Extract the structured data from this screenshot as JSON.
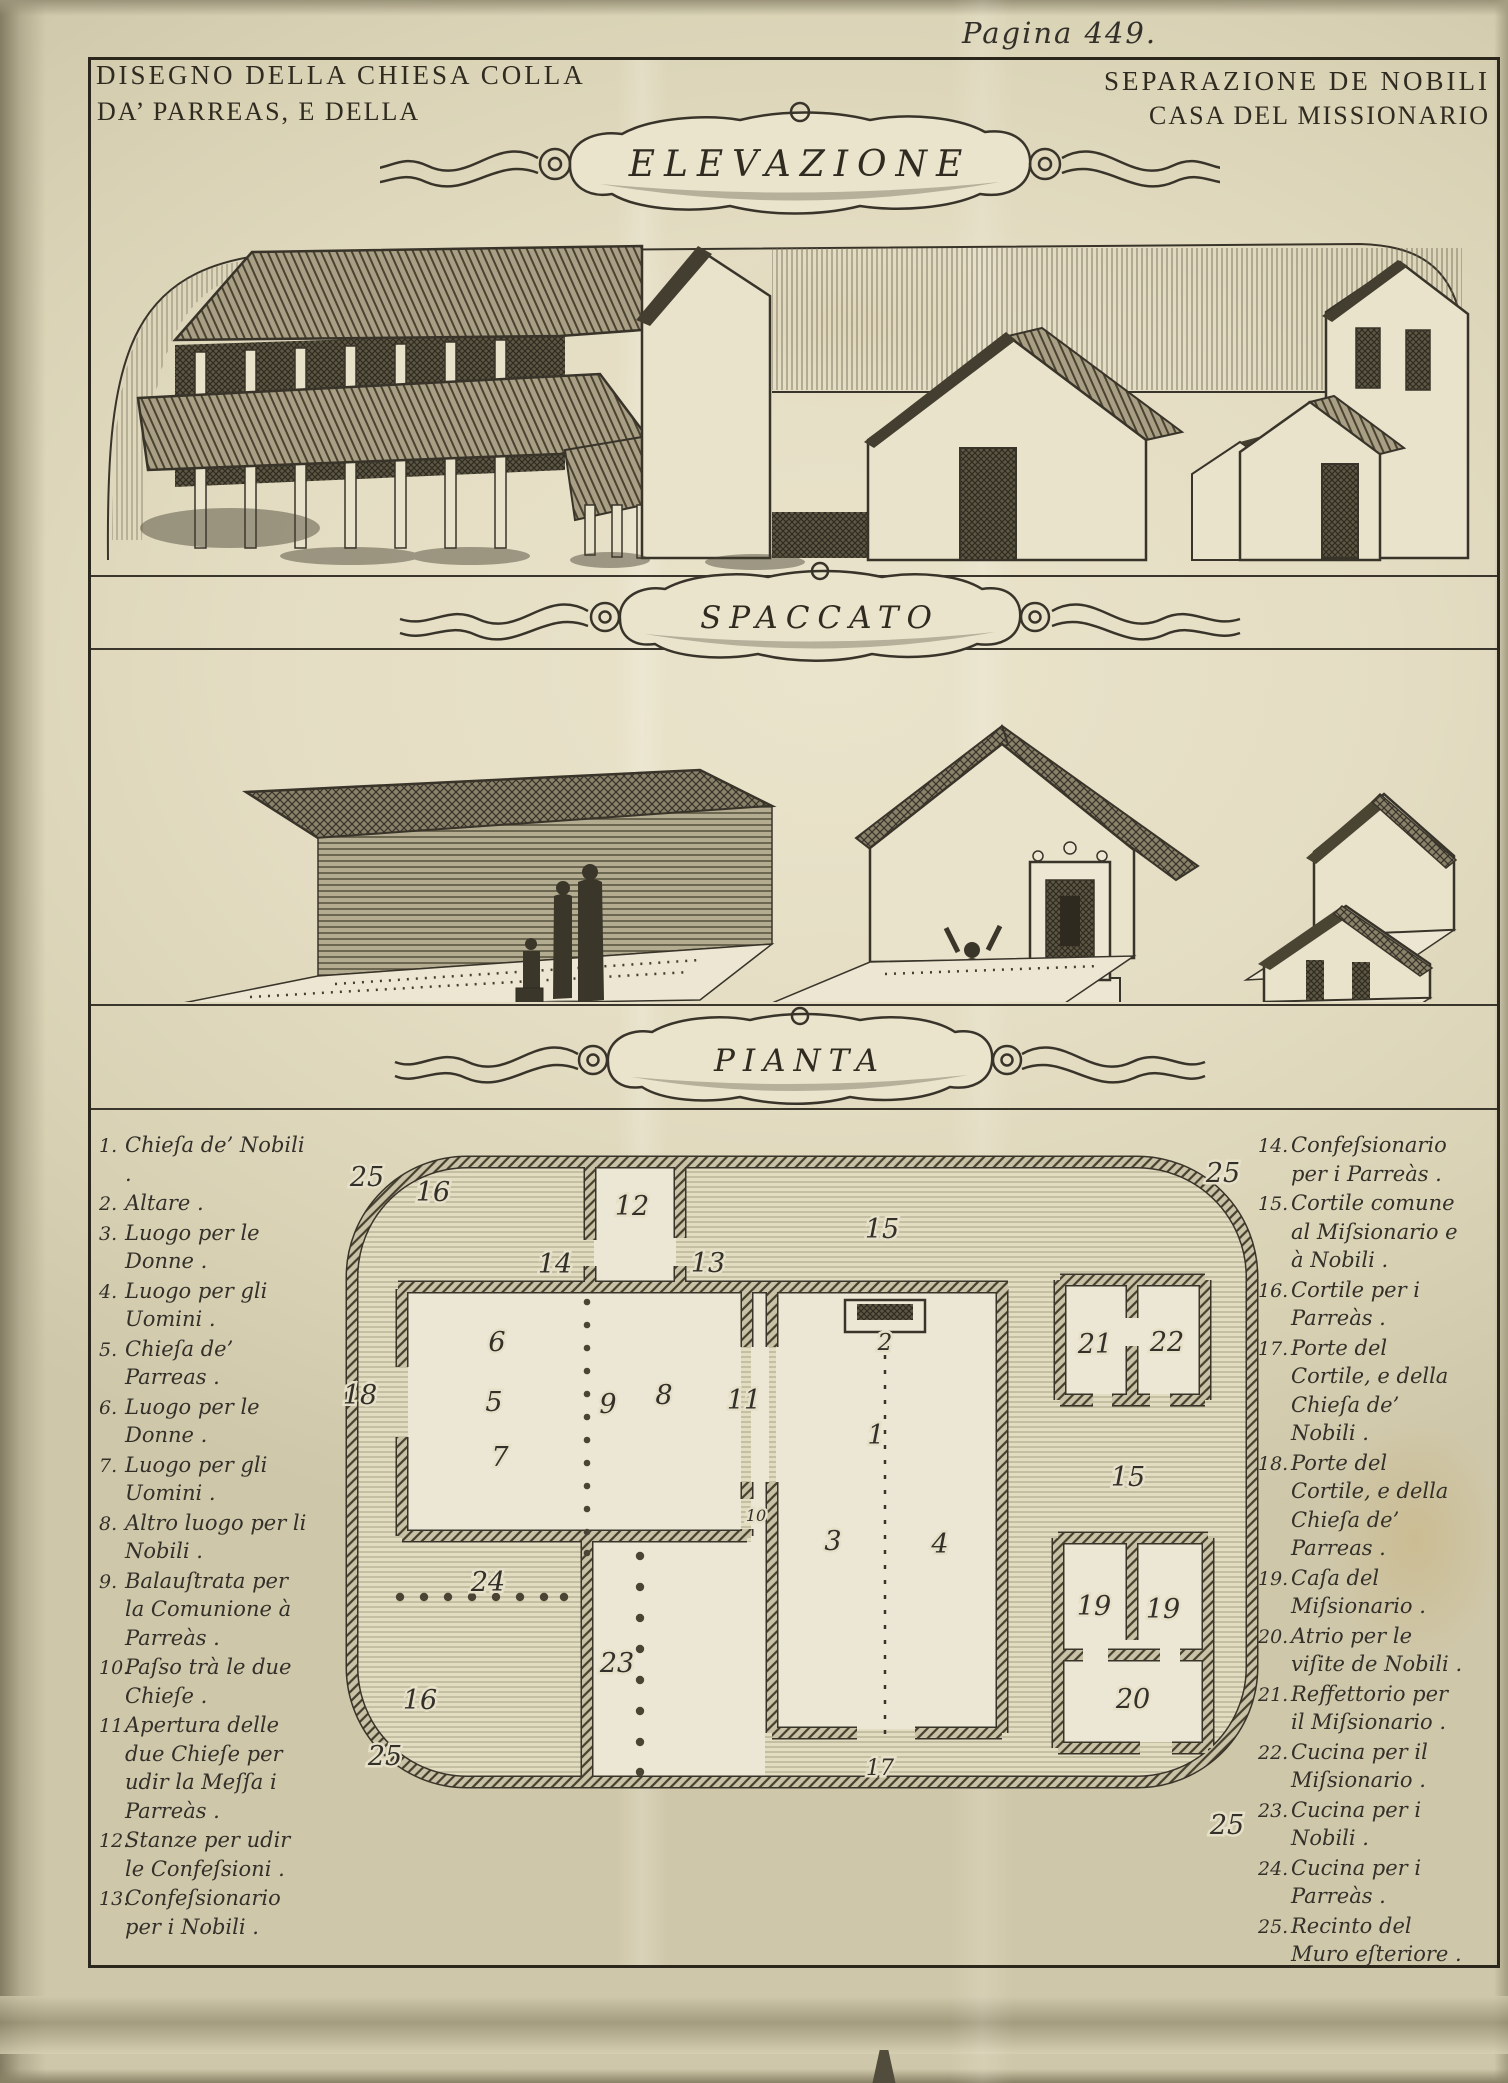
{
  "page": {
    "page_label": "Pagina 449."
  },
  "titles": {
    "line1_left": "DISEGNO DELLA CHIESA COLLA",
    "line1_right": "SEPARAZIONE DE NOBILI",
    "line2_left": "DA’ PARREAS, E DELLA",
    "line2_right": "CASA DEL MISSIONARIO",
    "elevation": "ELEVAZIONE",
    "section": "SPACCATO",
    "plan": "PIANTA"
  },
  "legend_left": {
    "items": [
      {
        "num": "1.",
        "text": "Chieſa de’ Nobili ."
      },
      {
        "num": "2.",
        "text": "Altare ."
      },
      {
        "num": "3.",
        "text": "Luogo per le Donne ."
      },
      {
        "num": "4.",
        "text": "Luogo per gli Uomini ."
      },
      {
        "num": "5.",
        "text": "Chieſa de’ Parreas ."
      },
      {
        "num": "6.",
        "text": "Luogo per le Donne ."
      },
      {
        "num": "7.",
        "text": "Luogo per gli Uomini ."
      },
      {
        "num": "8.",
        "text": "Altro luogo per li Nobili ."
      },
      {
        "num": "9.",
        "text": "Balauſtrata per la Comunione à Parreàs ."
      },
      {
        "num": "10.",
        "text": "Paſso trà le due Chieſe ."
      },
      {
        "num": "11.",
        "text": "Apertura delle due Chieſe per udir la Meſſa i Parreàs ."
      },
      {
        "num": "12.",
        "text": "Stanze per udir le Confeſsioni ."
      },
      {
        "num": "13.",
        "text": "Confeſsionario per i Nobili ."
      }
    ]
  },
  "legend_right": {
    "items": [
      {
        "num": "14.",
        "text": "Confeſsionario per i Parreàs ."
      },
      {
        "num": "15.",
        "text": "Cortile comune al Miſsionario e à Nobili ."
      },
      {
        "num": "16.",
        "text": "Cortile per i Parreàs ."
      },
      {
        "num": "17.",
        "text": "Porte del Cortile, e della Chieſa de’ Nobili ."
      },
      {
        "num": "18.",
        "text": "Porte del Cortile, e della Chieſa de’ Parreas ."
      },
      {
        "num": "19.",
        "text": "Caſa del Miſsionario ."
      },
      {
        "num": "20.",
        "text": "Atrio per le viſite de Nobili ."
      },
      {
        "num": "21.",
        "text": "Reffettorio per il Miſsionario ."
      },
      {
        "num": "22.",
        "text": "Cucina per il Miſsionario ."
      },
      {
        "num": "23.",
        "text": "Cucina per i Nobili ."
      },
      {
        "num": "24.",
        "text": "Cucina per i Parreàs ."
      },
      {
        "num": "25.",
        "text": "Recinto del Muro eſteriore ."
      }
    ]
  },
  "plan_numbers": {
    "n1": "1",
    "n2": "2",
    "n3": "3",
    "n4": "4",
    "n5": "5",
    "n6": "6",
    "n7": "7",
    "n8": "8",
    "n9": "9",
    "n10": "10",
    "n11": "11",
    "n12": "12",
    "n13": "13",
    "n14": "14",
    "n15a": "15",
    "n15b": "15",
    "n16a": "16",
    "n16b": "16",
    "n17": "17",
    "n18": "18",
    "n19a": "19",
    "n19b": "19",
    "n20": "20",
    "n21": "21",
    "n22": "22",
    "n23": "23",
    "n24": "24",
    "n25a": "25",
    "n25b": "25",
    "n25c": "25",
    "n25d": "25"
  }
}
